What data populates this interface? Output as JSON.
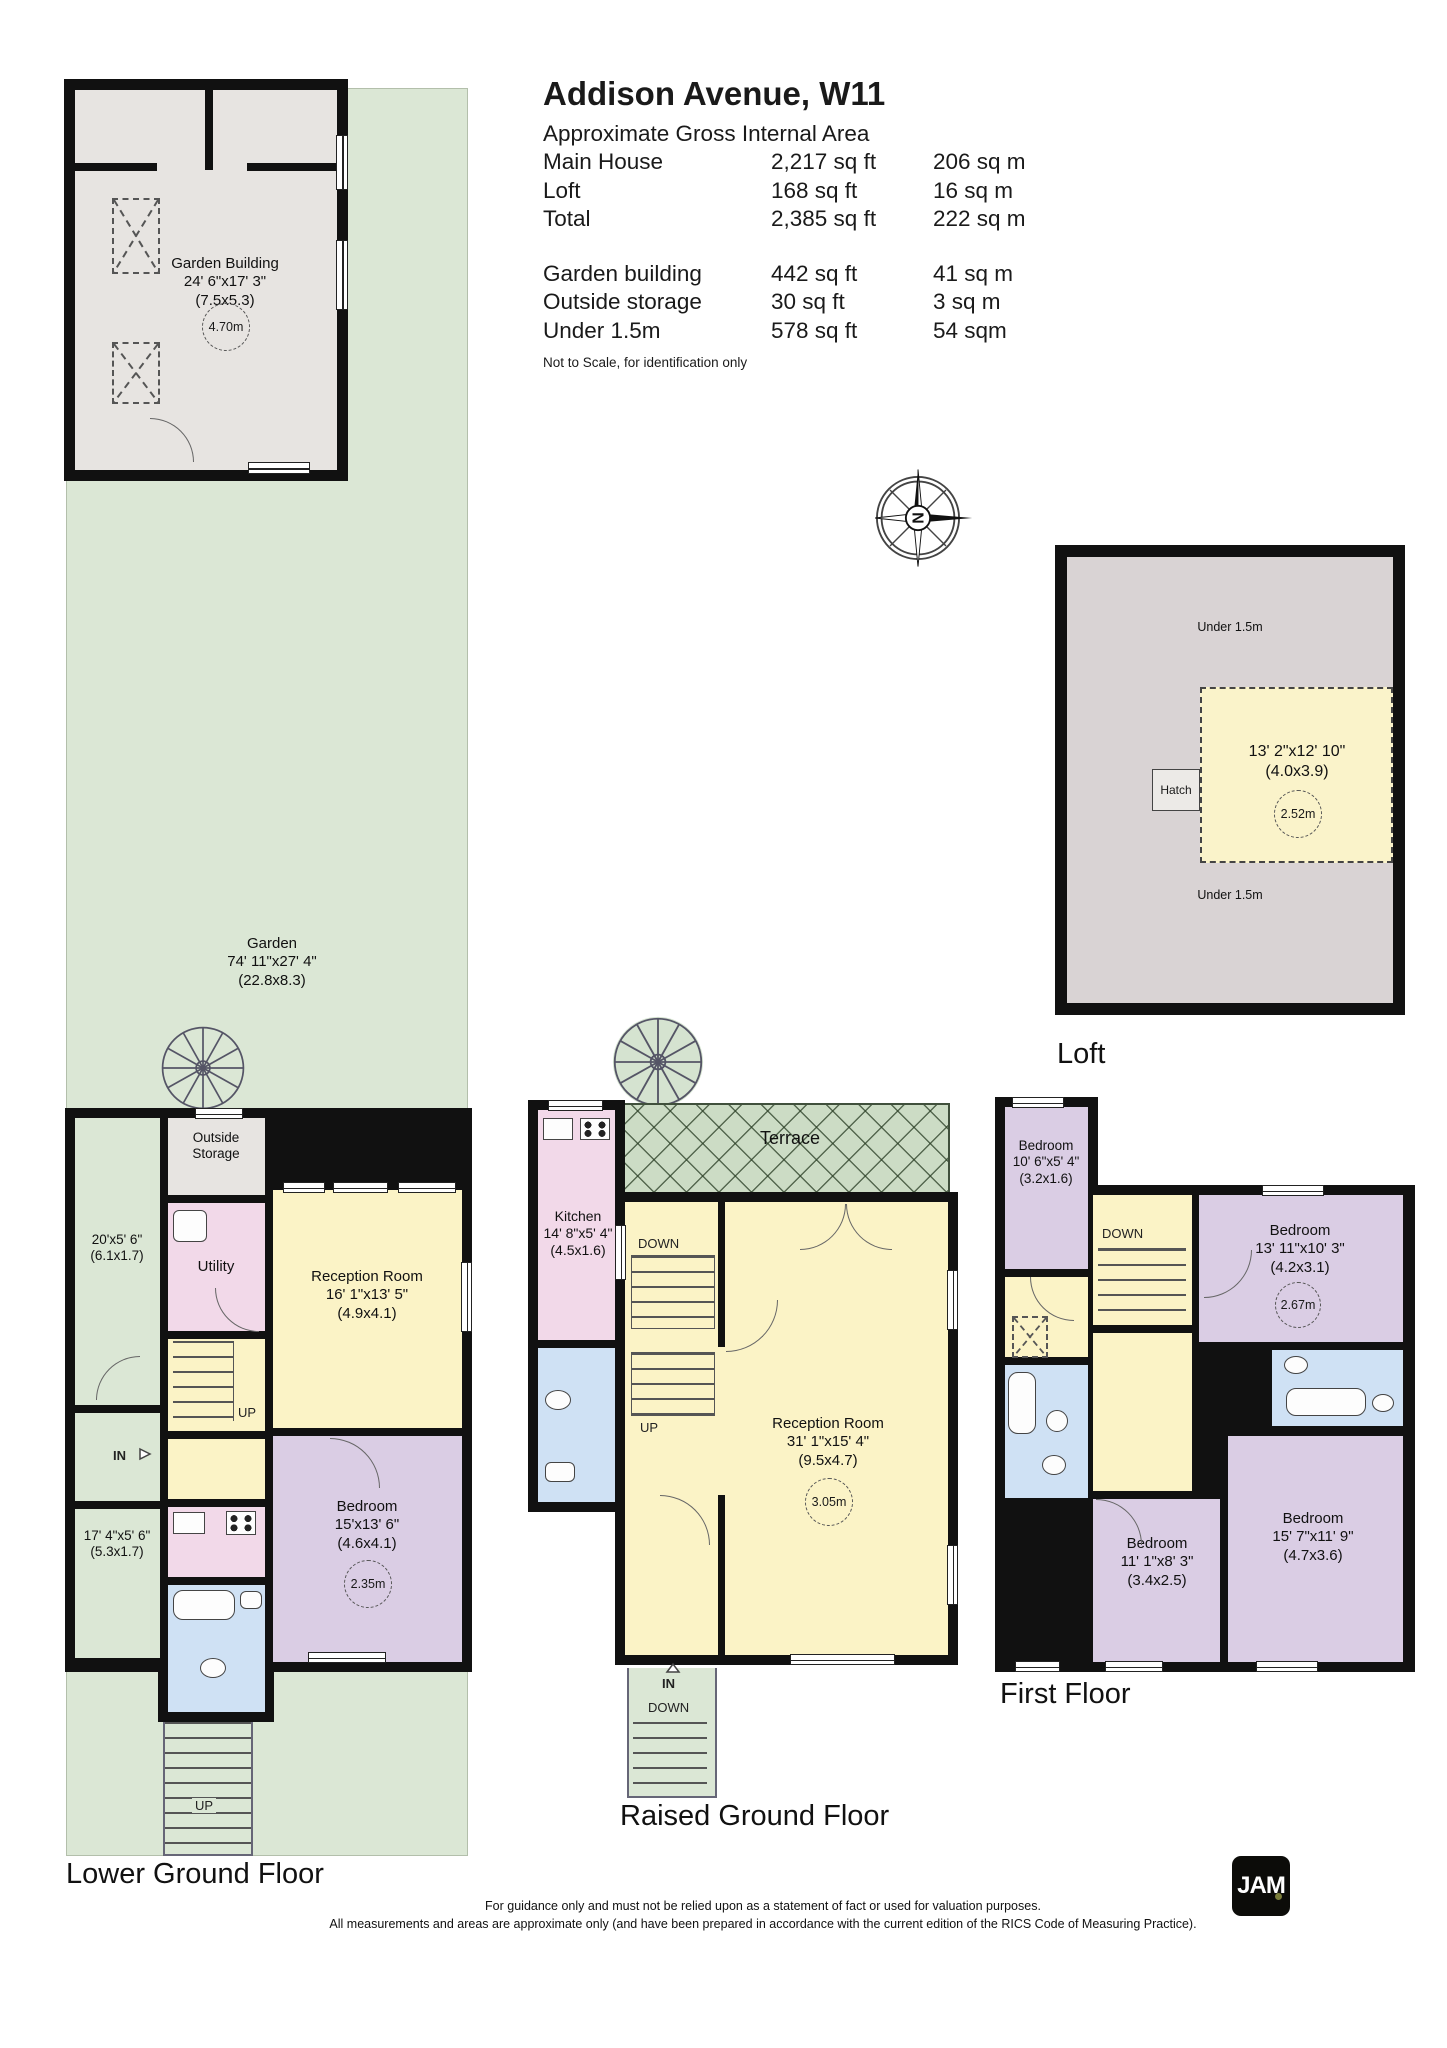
{
  "header": {
    "title": "Addison Avenue, W11",
    "subtitle": "Approximate Gross Internal Area",
    "area_rows": [
      {
        "label": "Main House",
        "sqft": "2,217 sq ft",
        "sqm": "206 sq m"
      },
      {
        "label": "Loft",
        "sqft": "168 sq ft",
        "sqm": "16 sq m"
      },
      {
        "label": "Total",
        "sqft": "2,385 sq ft",
        "sqm": "222 sq m"
      }
    ],
    "outbuilding_rows": [
      {
        "label": "Garden building",
        "sqft": "442 sq ft",
        "sqm": "41 sq m"
      },
      {
        "label": "Outside storage",
        "sqft": "30 sq ft",
        "sqm": "3 sq m"
      },
      {
        "label": "Under 1.5m",
        "sqft": "578 sq ft",
        "sqm": "54 sqm"
      }
    ],
    "note": "Not to Scale, for identification only"
  },
  "compass": {
    "north_letter": "N"
  },
  "garden": {
    "name": "Garden",
    "dims": "74' 11\"x27' 4\"",
    "metric": "(22.8x8.3)"
  },
  "garden_building": {
    "name": "Garden Building",
    "dims": "24' 6\"x17' 3\"",
    "metric": "(7.5x5.3)",
    "height": "4.70m"
  },
  "loft": {
    "label": "Loft",
    "under_eaves_top": "Under 1.5m",
    "under_eaves_bottom": "Under 1.5m",
    "room_dims": "13' 2\"x12' 10\"",
    "room_metric": "(4.0x3.9)",
    "room_height": "2.52m",
    "hatch": "Hatch"
  },
  "lower_ground": {
    "label": "Lower Ground Floor",
    "passage_upper": {
      "dims": "20'x5' 6\"",
      "metric": "(6.1x1.7)"
    },
    "passage_lower": {
      "dims": "17' 4\"x5' 6\"",
      "metric": "(5.3x1.7)"
    },
    "outside_storage": "Outside Storage",
    "utility": "Utility",
    "reception": {
      "name": "Reception Room",
      "dims": "16' 1\"x13' 5\"",
      "metric": "(4.9x4.1)"
    },
    "bedroom": {
      "name": "Bedroom",
      "dims": "15'x13' 6\"",
      "metric": "(4.6x4.1)",
      "height": "2.35m"
    },
    "up_label": "UP",
    "in_label": "IN",
    "ext_up_label": "UP"
  },
  "raised_ground": {
    "label": "Raised Ground Floor",
    "terrace": "Terrace",
    "kitchen": {
      "name": "Kitchen",
      "dims": "14' 8\"x5' 4\"",
      "metric": "(4.5x1.6)"
    },
    "reception": {
      "name": "Reception Room",
      "dims": "31' 1\"x15' 4\"",
      "metric": "(9.5x4.7)",
      "height": "3.05m"
    },
    "down_label": "DOWN",
    "up_label": "UP",
    "in_label": "IN",
    "ext_down_label": "DOWN"
  },
  "first_floor": {
    "label": "First Floor",
    "bedroom_small": {
      "name": "Bedroom",
      "dims": "10' 6\"x5' 4\"",
      "metric": "(3.2x1.6)"
    },
    "bedroom_right": {
      "name": "Bedroom",
      "dims": "13' 11\"x10' 3\"",
      "metric": "(4.2x3.1)",
      "height": "2.67m"
    },
    "bedroom_mid": {
      "name": "Bedroom",
      "dims": "11' 1\"x8' 3\"",
      "metric": "(3.4x2.5)"
    },
    "bedroom_large": {
      "name": "Bedroom",
      "dims": "15' 7\"x11' 9\"",
      "metric": "(4.7x3.6)"
    },
    "down_label": "DOWN"
  },
  "footer": {
    "line1": "For guidance only and must not be relied upon as a statement of fact or used for valuation purposes.",
    "line2": "All measurements and areas are approximate only (and have been prepared in accordance with the current edition of the RICS Code of Measuring Practice).",
    "logo": "JAM"
  },
  "colors": {
    "garden_green": "#dbe7d5",
    "terrace_green": "#ccdcc5",
    "room_yellow": "#fbf3c6",
    "room_pink": "#f2d9e9",
    "room_purple": "#dacde4",
    "room_blue": "#cfe1f4",
    "storage_grey": "#e7e4e1",
    "loft_grey": "#d9d3d4",
    "wall_black": "#111111"
  }
}
